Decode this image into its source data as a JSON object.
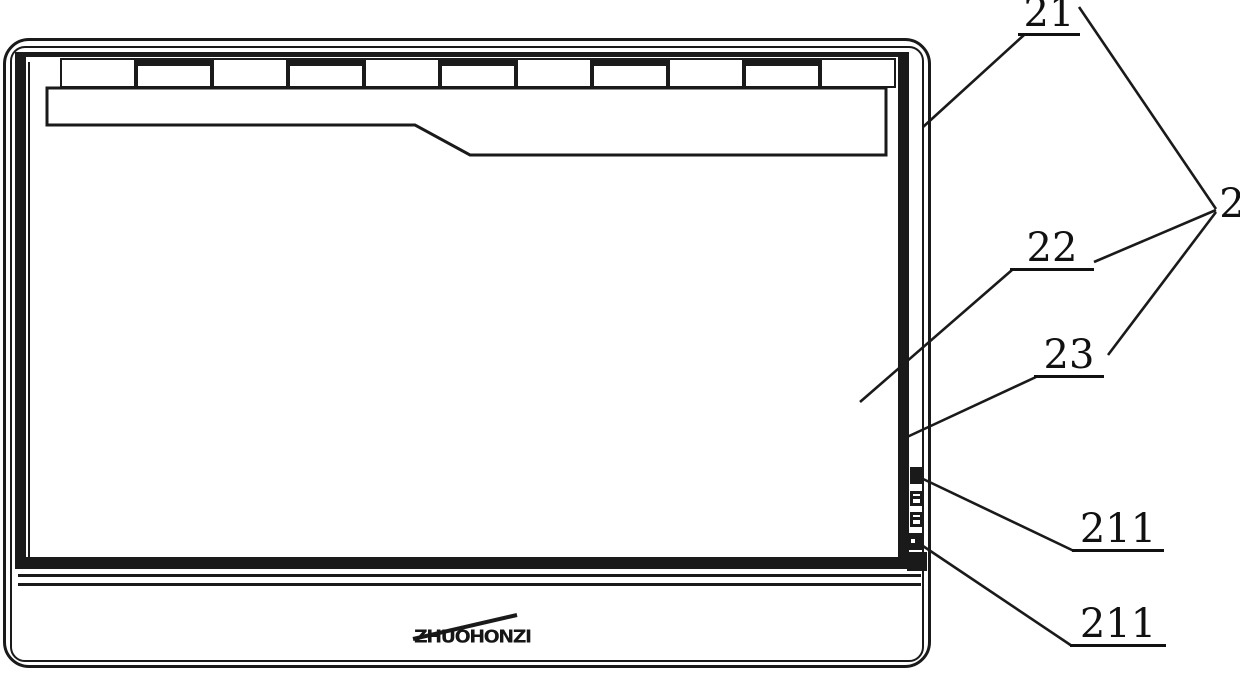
{
  "figure": {
    "labels": {
      "ref2": "2",
      "ref21": "21",
      "ref22": "22",
      "ref23": "23",
      "ref211_upper": "211",
      "ref211_lower": "211"
    },
    "logo_text": "ZHUOHONZI",
    "colors": {
      "ink": "#1a1a1a",
      "background": "#ffffff"
    }
  }
}
